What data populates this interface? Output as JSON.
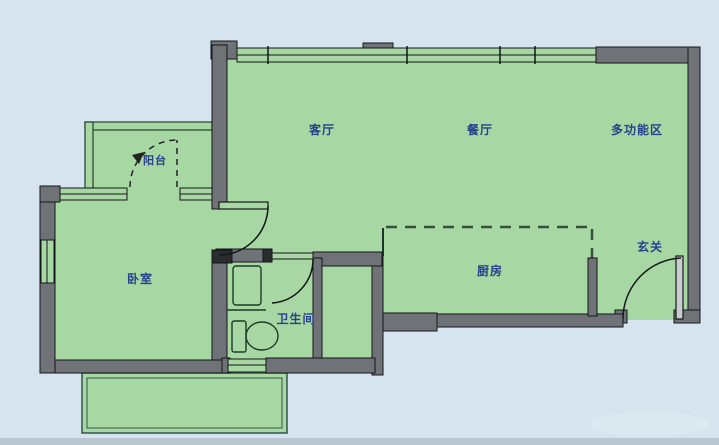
{
  "floorplan": {
    "rooms": [
      {
        "id": "living",
        "label": "客厅"
      },
      {
        "id": "dining",
        "label": "餐厅"
      },
      {
        "id": "multi",
        "label": "多功能区"
      },
      {
        "id": "balcony",
        "label": "阳台"
      },
      {
        "id": "bedroom",
        "label": "卧室"
      },
      {
        "id": "bathroom",
        "label": "卫生间"
      },
      {
        "id": "kitchen",
        "label": "厨房"
      },
      {
        "id": "entry",
        "label": "玄关"
      }
    ],
    "colors": {
      "background": "#d5e4ee",
      "background_bottom_strip": "#bac7d1",
      "floor_green": "#a7d7a3",
      "wall_gray": "#6f7378",
      "wall_outline": "#141619",
      "label_navy": "#28418e",
      "window_line": "#1c3526",
      "dashed_boundary": "#39503f"
    }
  }
}
